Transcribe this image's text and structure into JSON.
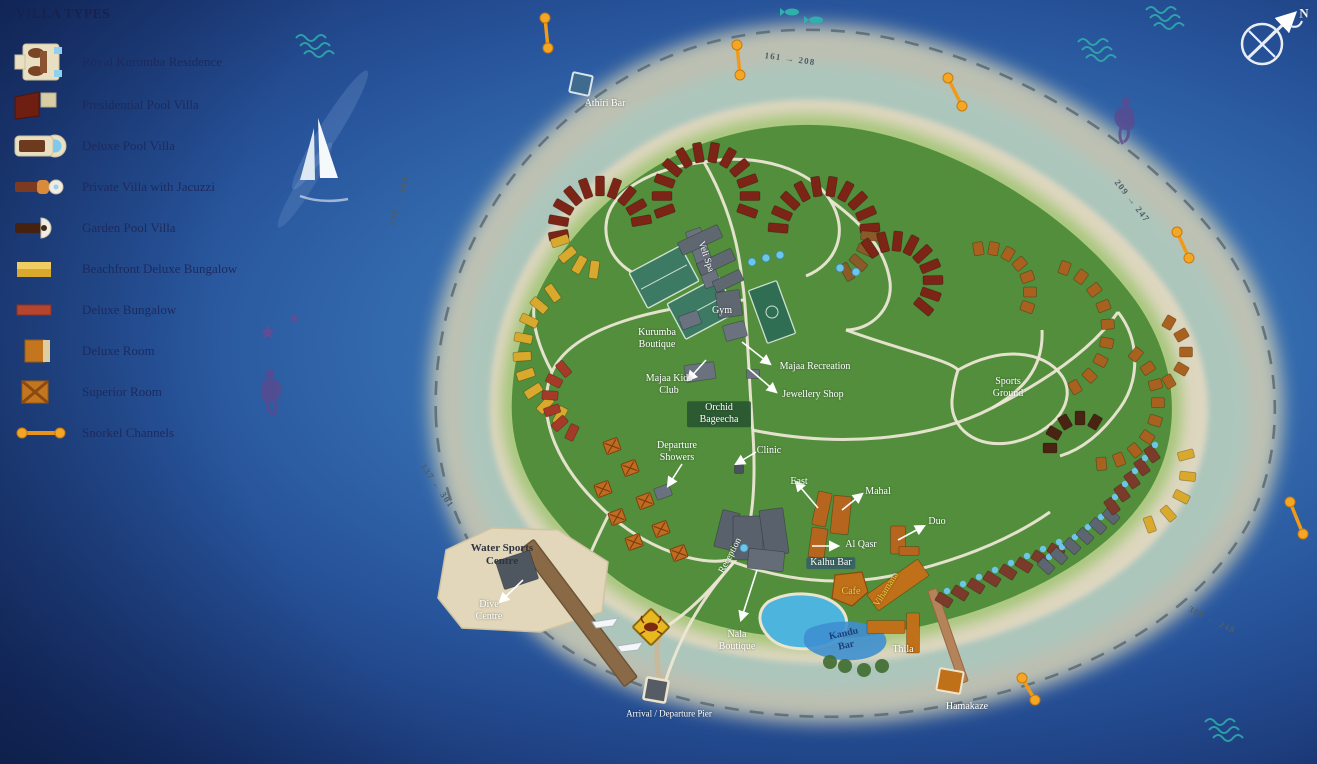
{
  "legend": {
    "title": "VILLA TYPES",
    "items": [
      {
        "id": "royal-kurumba-residence",
        "label": "Royal Kurumba Residence"
      },
      {
        "id": "presidential-pool-villa",
        "label": "Presidential Pool Villa"
      },
      {
        "id": "deluxe-pool-villa",
        "label": "Deluxe Pool Villa"
      },
      {
        "id": "private-villa-with-jacuzzi",
        "label": "Private Villa with Jacuzzi"
      },
      {
        "id": "garden-pool-villa",
        "label": "Garden Pool Villa"
      },
      {
        "id": "beachfront-deluxe-bungalow",
        "label": "Beachfront Deluxe Bungalow"
      },
      {
        "id": "deluxe-bungalow",
        "label": "Deluxe Bungalow"
      },
      {
        "id": "deluxe-room",
        "label": "Deluxe Room"
      },
      {
        "id": "superior-room",
        "label": "Superior Room"
      },
      {
        "id": "snorkel-channels",
        "label": "Snorkel Channels"
      }
    ]
  },
  "map": {
    "labels": {
      "athiri_bar": "Athiri Bar",
      "veli_spa": "Veli Spa",
      "gym": "Gym",
      "kurumba_boutique": "Kurumba Boutique",
      "majaa_kids_club": "Majaa Kids Club",
      "majaa_recreation": "Majaa Recreation",
      "jewellery_shop": "Jewellery Shop",
      "orchid_bageecha": "Orchid Bageecha",
      "departure_showers": "Departure Showers",
      "clinic": "Clinic",
      "east": "East",
      "mahal": "Mahal",
      "al_qasr": "Al Qasr",
      "duo": "Duo",
      "kalhu_bar": "Kalhu Bar",
      "cafe": "Cafe",
      "vihamana": "Vihamana",
      "reception": "Reception",
      "sports_ground": "Sports Ground",
      "water_sports_centre": "Water Sports Centre",
      "dive_centre": "Dive Centre",
      "nala_boutique": "Nala Boutique",
      "arrival_departure_pier": "Arrival / Departure Pier",
      "kandu_bar": "Kandu Bar",
      "thila": "Thila",
      "hamakaze": "Hamakaze"
    },
    "room_ranges": {
      "north": "161 → 208",
      "west": "138 → 160",
      "east": "209 → 247",
      "southwest": "137 ← 301",
      "southeast": "300 ← 248"
    },
    "compass": {
      "north_label": "N"
    }
  },
  "colors": {
    "ocean_deep": "#16306b",
    "ocean_light": "#4379ba",
    "island_green": "#538e3c",
    "beach_sand": "#ded7c0",
    "reef_sand": "#c9c9b4",
    "marker_orange": "#f5a623",
    "dashed_line": "#5d6d75",
    "villa_red": "#7c2415",
    "villa_yellow": "#d9a92d",
    "villa_orange": "#c4761f",
    "building_gray": "#5f6771",
    "pool_blue": "#4db4dd"
  }
}
